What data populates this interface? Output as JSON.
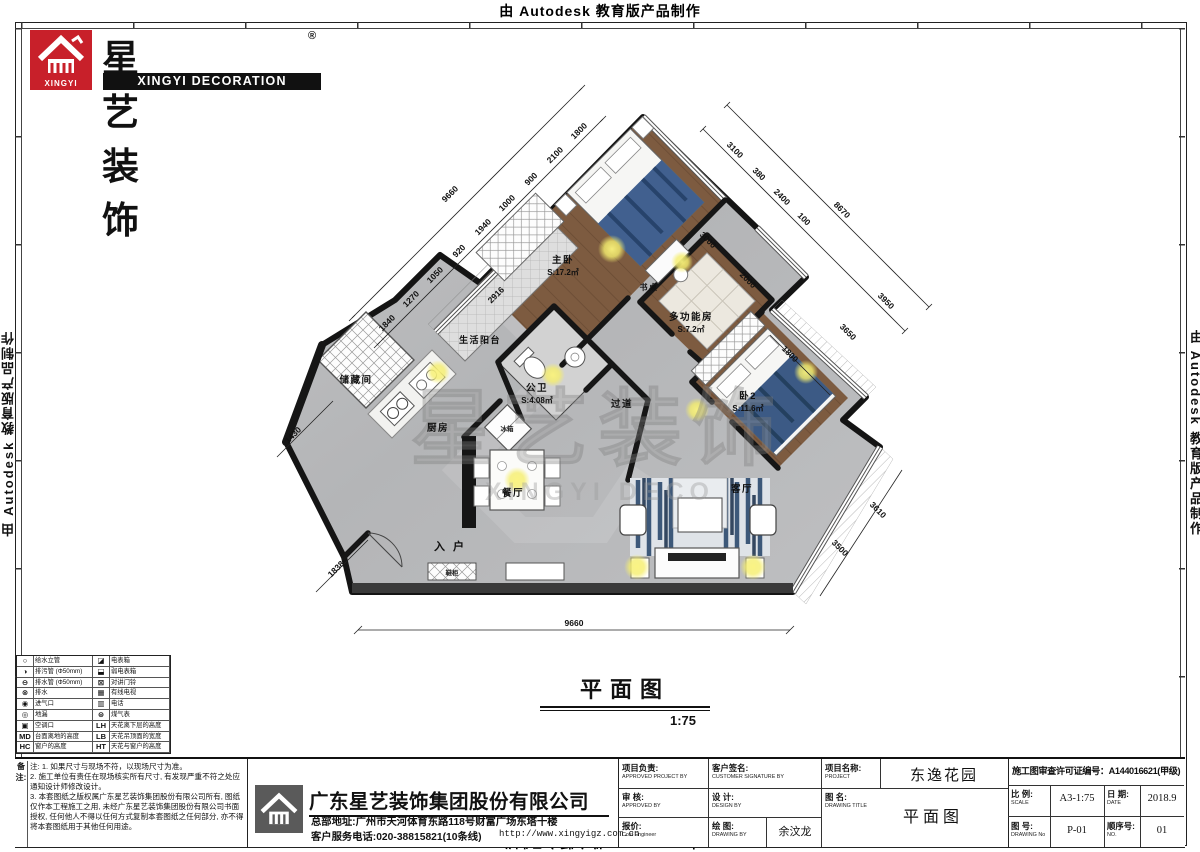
{
  "banner": {
    "text": "由 Autodesk 教育版产品制作"
  },
  "brand": {
    "cn": "星艺装饰",
    "reg": "®",
    "en": "XINGYI DECORATION",
    "logo_text": "XINGYI"
  },
  "plan": {
    "title": "平面图",
    "scale": "1:75",
    "watermark_cn": "星艺装饰",
    "watermark_en": "XINGYI DECO",
    "rooms": [
      {
        "n": "主卧",
        "a": "S:17.2㎡",
        "x": 563,
        "y": 263
      },
      {
        "n": "书桌",
        "x": 649,
        "y": 290,
        "fs": 8
      },
      {
        "n": "多功能房",
        "a": "S:7.2㎡",
        "x": 691,
        "y": 320
      },
      {
        "n": "卧2",
        "a": "S:11.6㎡",
        "x": 748,
        "y": 399
      },
      {
        "n": "生活阳台",
        "x": 480,
        "y": 343,
        "fs": 9
      },
      {
        "n": "储藏间",
        "x": 356,
        "y": 383
      },
      {
        "n": "公卫",
        "a": "S:4.08㎡",
        "x": 537,
        "y": 391
      },
      {
        "n": "过道",
        "x": 622,
        "y": 407
      },
      {
        "n": "厨房",
        "x": 438,
        "y": 431
      },
      {
        "n": "餐厅",
        "x": 513,
        "y": 496
      },
      {
        "n": "客厅",
        "x": 742,
        "y": 492
      },
      {
        "n": "入户",
        "x": 453,
        "y": 550,
        "sp": 8,
        "fs": 11
      }
    ],
    "furniture_labels": [
      {
        "n": "冰箱",
        "x": 507,
        "y": 431
      },
      {
        "n": "鞋柜",
        "x": 452,
        "y": 575
      }
    ],
    "dimensions": [
      {
        "v": "9660",
        "x": 574,
        "y": 626,
        "r": 0
      },
      {
        "v": "9660",
        "x": 452,
        "y": 196,
        "r": -45
      },
      {
        "v": "1840",
        "x": 389,
        "y": 325,
        "r": -45
      },
      {
        "v": "1270",
        "x": 413,
        "y": 301,
        "r": -45
      },
      {
        "v": "1050",
        "x": 437,
        "y": 277,
        "r": -45
      },
      {
        "v": "920",
        "x": 461,
        "y": 253,
        "r": -45
      },
      {
        "v": "1940",
        "x": 485,
        "y": 229,
        "r": -45
      },
      {
        "v": "1000",
        "x": 509,
        "y": 205,
        "r": -45
      },
      {
        "v": "900",
        "x": 533,
        "y": 181,
        "r": -45
      },
      {
        "v": "2100",
        "x": 557,
        "y": 157,
        "r": -45
      },
      {
        "v": "1800",
        "x": 581,
        "y": 133,
        "r": -45
      },
      {
        "v": "2916",
        "x": 498,
        "y": 297,
        "r": -45
      },
      {
        "v": "1430",
        "x": 295,
        "y": 437,
        "r": -45
      },
      {
        "v": "1838",
        "x": 338,
        "y": 571,
        "r": -45
      },
      {
        "v": "3100",
        "x": 733,
        "y": 152,
        "r": 45
      },
      {
        "v": "380",
        "x": 757,
        "y": 176,
        "r": 45
      },
      {
        "v": "2400",
        "x": 780,
        "y": 199,
        "r": 45
      },
      {
        "v": "100",
        "x": 802,
        "y": 221,
        "r": 45
      },
      {
        "v": "8670",
        "x": 840,
        "y": 212,
        "r": 45
      },
      {
        "v": "3000",
        "x": 706,
        "y": 242,
        "r": 45
      },
      {
        "v": "2000",
        "x": 746,
        "y": 282,
        "r": 45
      },
      {
        "v": "3650",
        "x": 846,
        "y": 334,
        "r": 45
      },
      {
        "v": "3950",
        "x": 884,
        "y": 303,
        "r": 45
      },
      {
        "v": "1800",
        "x": 788,
        "y": 356,
        "r": 45
      },
      {
        "v": "3610",
        "x": 876,
        "y": 512,
        "r": 45
      },
      {
        "v": "3500",
        "x": 838,
        "y": 550,
        "r": 45
      }
    ]
  },
  "legend": {
    "rows": [
      {
        "ls": "○",
        "ll": "给水立管",
        "rs": "◪",
        "rl": "电表箱"
      },
      {
        "ls": "◑",
        "ll": "排污管 (Φ50mm)",
        "rs": "⬓",
        "rl": "弱电表箱"
      },
      {
        "ls": "⊖",
        "ll": "排水管 (Φ50mm)",
        "rs": "⊠",
        "rl": "对讲门铃"
      },
      {
        "ls": "⊗",
        "ll": "排水",
        "rs": "▦",
        "rl": "有线电视"
      },
      {
        "ls": "◉",
        "ll": "进气口",
        "rs": "▥",
        "rl": "电话"
      },
      {
        "ls": "◎",
        "ll": "地漏",
        "rs": "⊜",
        "rl": "煤气表"
      },
      {
        "ls": "▣",
        "ll": "空调口",
        "rs": "LH",
        "rl": "天花离下层的高度"
      },
      {
        "ls": "MD",
        "ll": "台面离地的高度",
        "rs": "LB",
        "rl": "天花吊顶面的宽度"
      },
      {
        "ls": "HC",
        "ll": "窗户的高度",
        "rs": "HT",
        "rl": "天花与窗户的高度"
      }
    ]
  },
  "notes": {
    "label": "备注:",
    "items": [
      "注: 1. 如果尺寸与现场不符，以现场尺寸为准。",
      "2. 施工单位有责任在现场核实所有尺寸, 有发现严重不符之处应通知设计师修改设计。",
      "3. 本套图纸之版权属广东星艺装饰集团股份有限公司所有, 图纸仅作本工程施工之用, 未经广东星艺装饰集团股份有限公司书面授权, 任何他人不得以任何方式复制本套图纸之任何部分, 亦不得将本套图纸用于其他任何用途。"
    ]
  },
  "company": {
    "name": "广东星艺装饰集团股份有限公司",
    "address": "总部地址:广州市天河体育东路118号财富广场东塔十楼",
    "phone": "客户服务电话:020-38815821(10条线)",
    "url": "http://www.xingyigz.com.cn"
  },
  "approval": {
    "a1_cn": "项目负责:",
    "a1_en": "APPROVED PROJECT BY",
    "a1_val": "",
    "a2_cn": "审 核:",
    "a2_en": "APPROVED BY",
    "a2_val": "",
    "a3_cn": "报价:",
    "a3_en": "Cost Engineer",
    "a3_val": "",
    "b1_cn": "客户签名:",
    "b1_en": "CUSTOMER SIGNATURE BY",
    "b1_val": "",
    "b2_cn": "设 计:",
    "b2_en": "DESIGN BY",
    "b2_val": "",
    "b3_cn": "绘 图:",
    "b3_en": "DRAWING BY",
    "b3_val": "余汶龙",
    "c1_cn": "项目名称:",
    "c1_en": "PROJECT",
    "c1_val": "东逸花园",
    "c2_cn": "图 名:",
    "c2_en": "DRAWING  TITLE",
    "c2_val": "平面图"
  },
  "info": {
    "permit": "施工图审查许可证编号：A144016621(甲级)",
    "scale_cn": "比 例:",
    "scale_en": "SCALE",
    "scale_val": "A3-1:75",
    "date_cn": "日 期:",
    "date_en": "DATE",
    "date_val": "2018.9",
    "dno_cn": "图 号:",
    "dno_en": "DRAWING No",
    "dno_val": "P-01",
    "seq_cn": "顺序号:",
    "seq_en": "NO.",
    "seq_val": "01"
  }
}
